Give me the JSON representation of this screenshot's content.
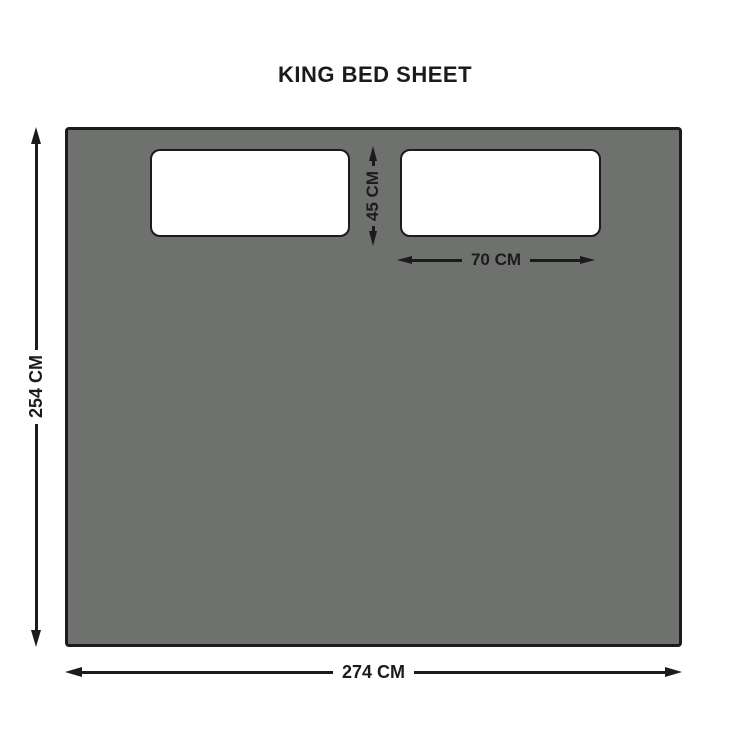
{
  "title": "KING BED SHEET",
  "diagram": {
    "object": "king-bed-sheet-with-two-pillows",
    "sheet": {
      "height_label": "254 CM",
      "width_label": "274 CM"
    },
    "pillow": {
      "height_label": "45 CM",
      "width_label": "70 CM"
    }
  },
  "colors": {
    "background": "#ffffff",
    "sheet_fill": "#6f716e",
    "pillow_fill": "#ffffff",
    "outline": "#1b1b1b"
  }
}
